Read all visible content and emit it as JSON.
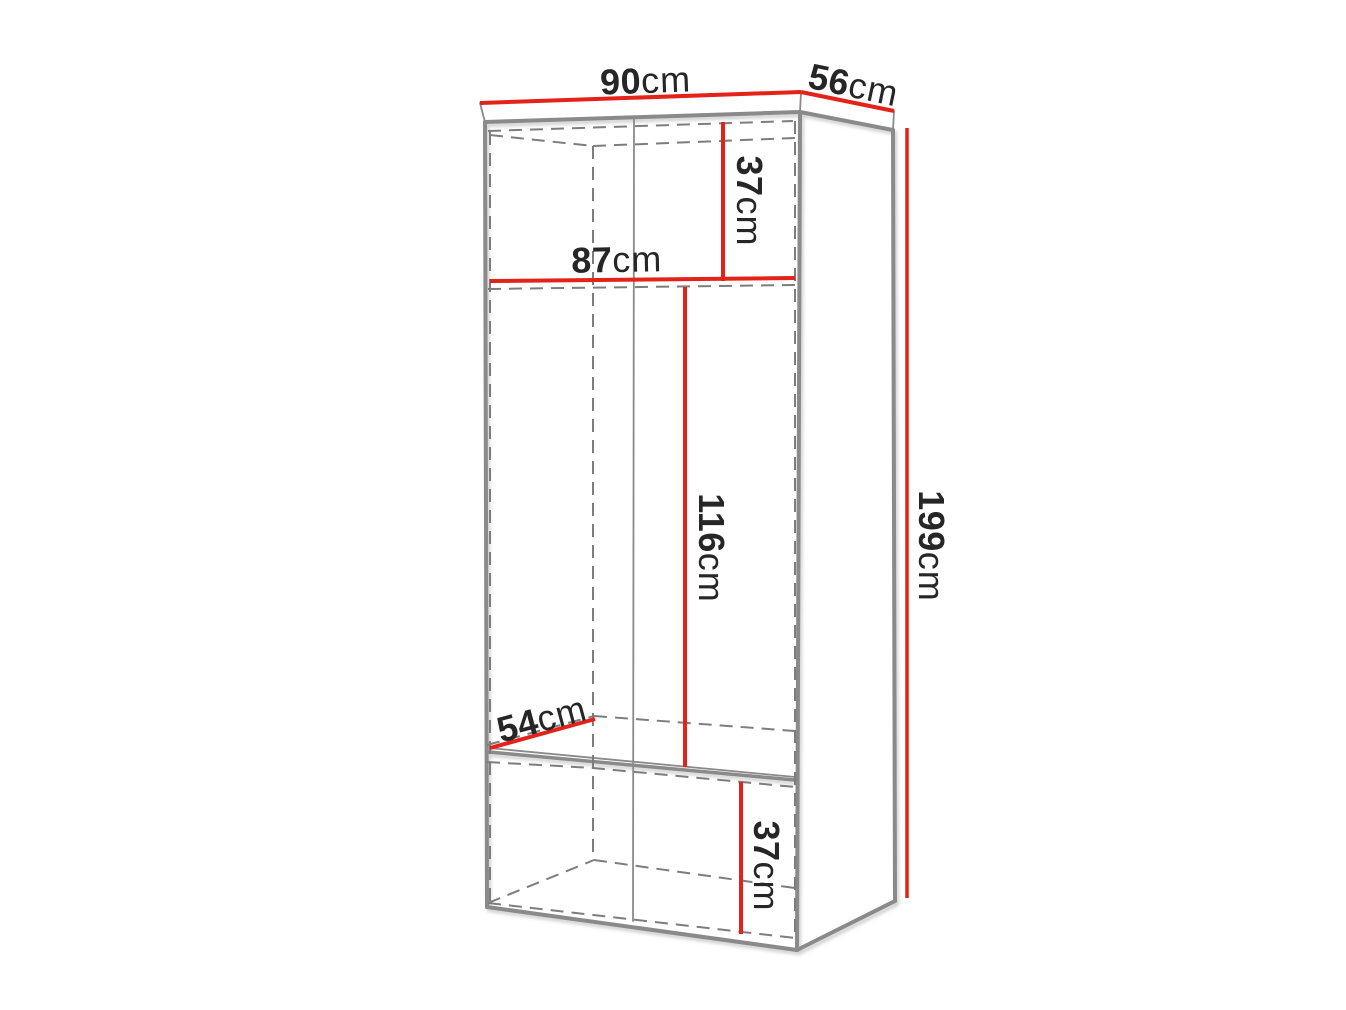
{
  "diagram": {
    "type": "furniture-dimension-drawing",
    "subject": "two-door wardrobe carcass, perspective view with dimension lines",
    "unit": "cm",
    "labels": {
      "top_width": {
        "value": "90",
        "unit": "cm"
      },
      "top_depth": {
        "value": "56",
        "unit": "cm"
      },
      "upper_section_height": {
        "value": "37",
        "unit": "cm"
      },
      "inner_width": {
        "value": "87",
        "unit": "cm"
      },
      "middle_section_height": {
        "value": "116",
        "unit": "cm"
      },
      "shelf_depth": {
        "value": "54",
        "unit": "cm"
      },
      "lower_section_height": {
        "value": "37",
        "unit": "cm"
      },
      "total_height": {
        "value": "199",
        "unit": "cm"
      }
    },
    "colors": {
      "dimension_line": "#e32219",
      "outline": "#8a8a8a",
      "hidden_line": "#7d7d7d",
      "label_text": "#262626",
      "background": "#ffffff"
    }
  }
}
